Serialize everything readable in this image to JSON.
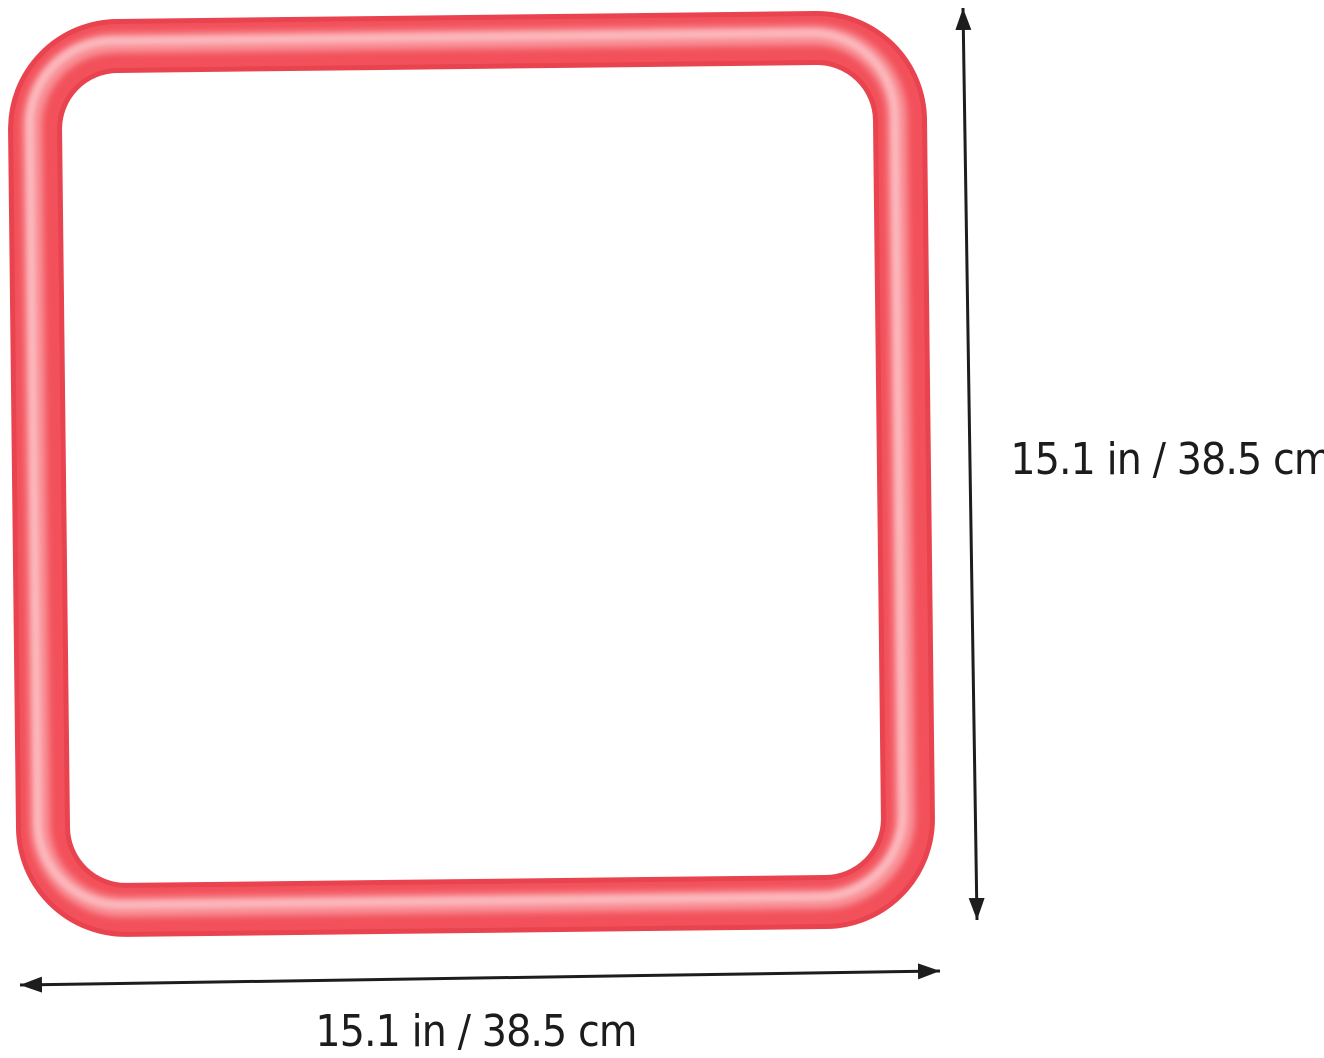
{
  "product": {
    "frame": {
      "description": "red square frame",
      "edge_color": "#e8434e",
      "base_color": "#f2515b",
      "highlight_color": "#f9969c",
      "gloss_color": "#fcbdc1"
    }
  },
  "dimensions": {
    "height_label": "15.1 in / 38.5 cm",
    "width_label": "15.1 in / 38.5 cm",
    "arrow_color": "#1d1d1d"
  }
}
